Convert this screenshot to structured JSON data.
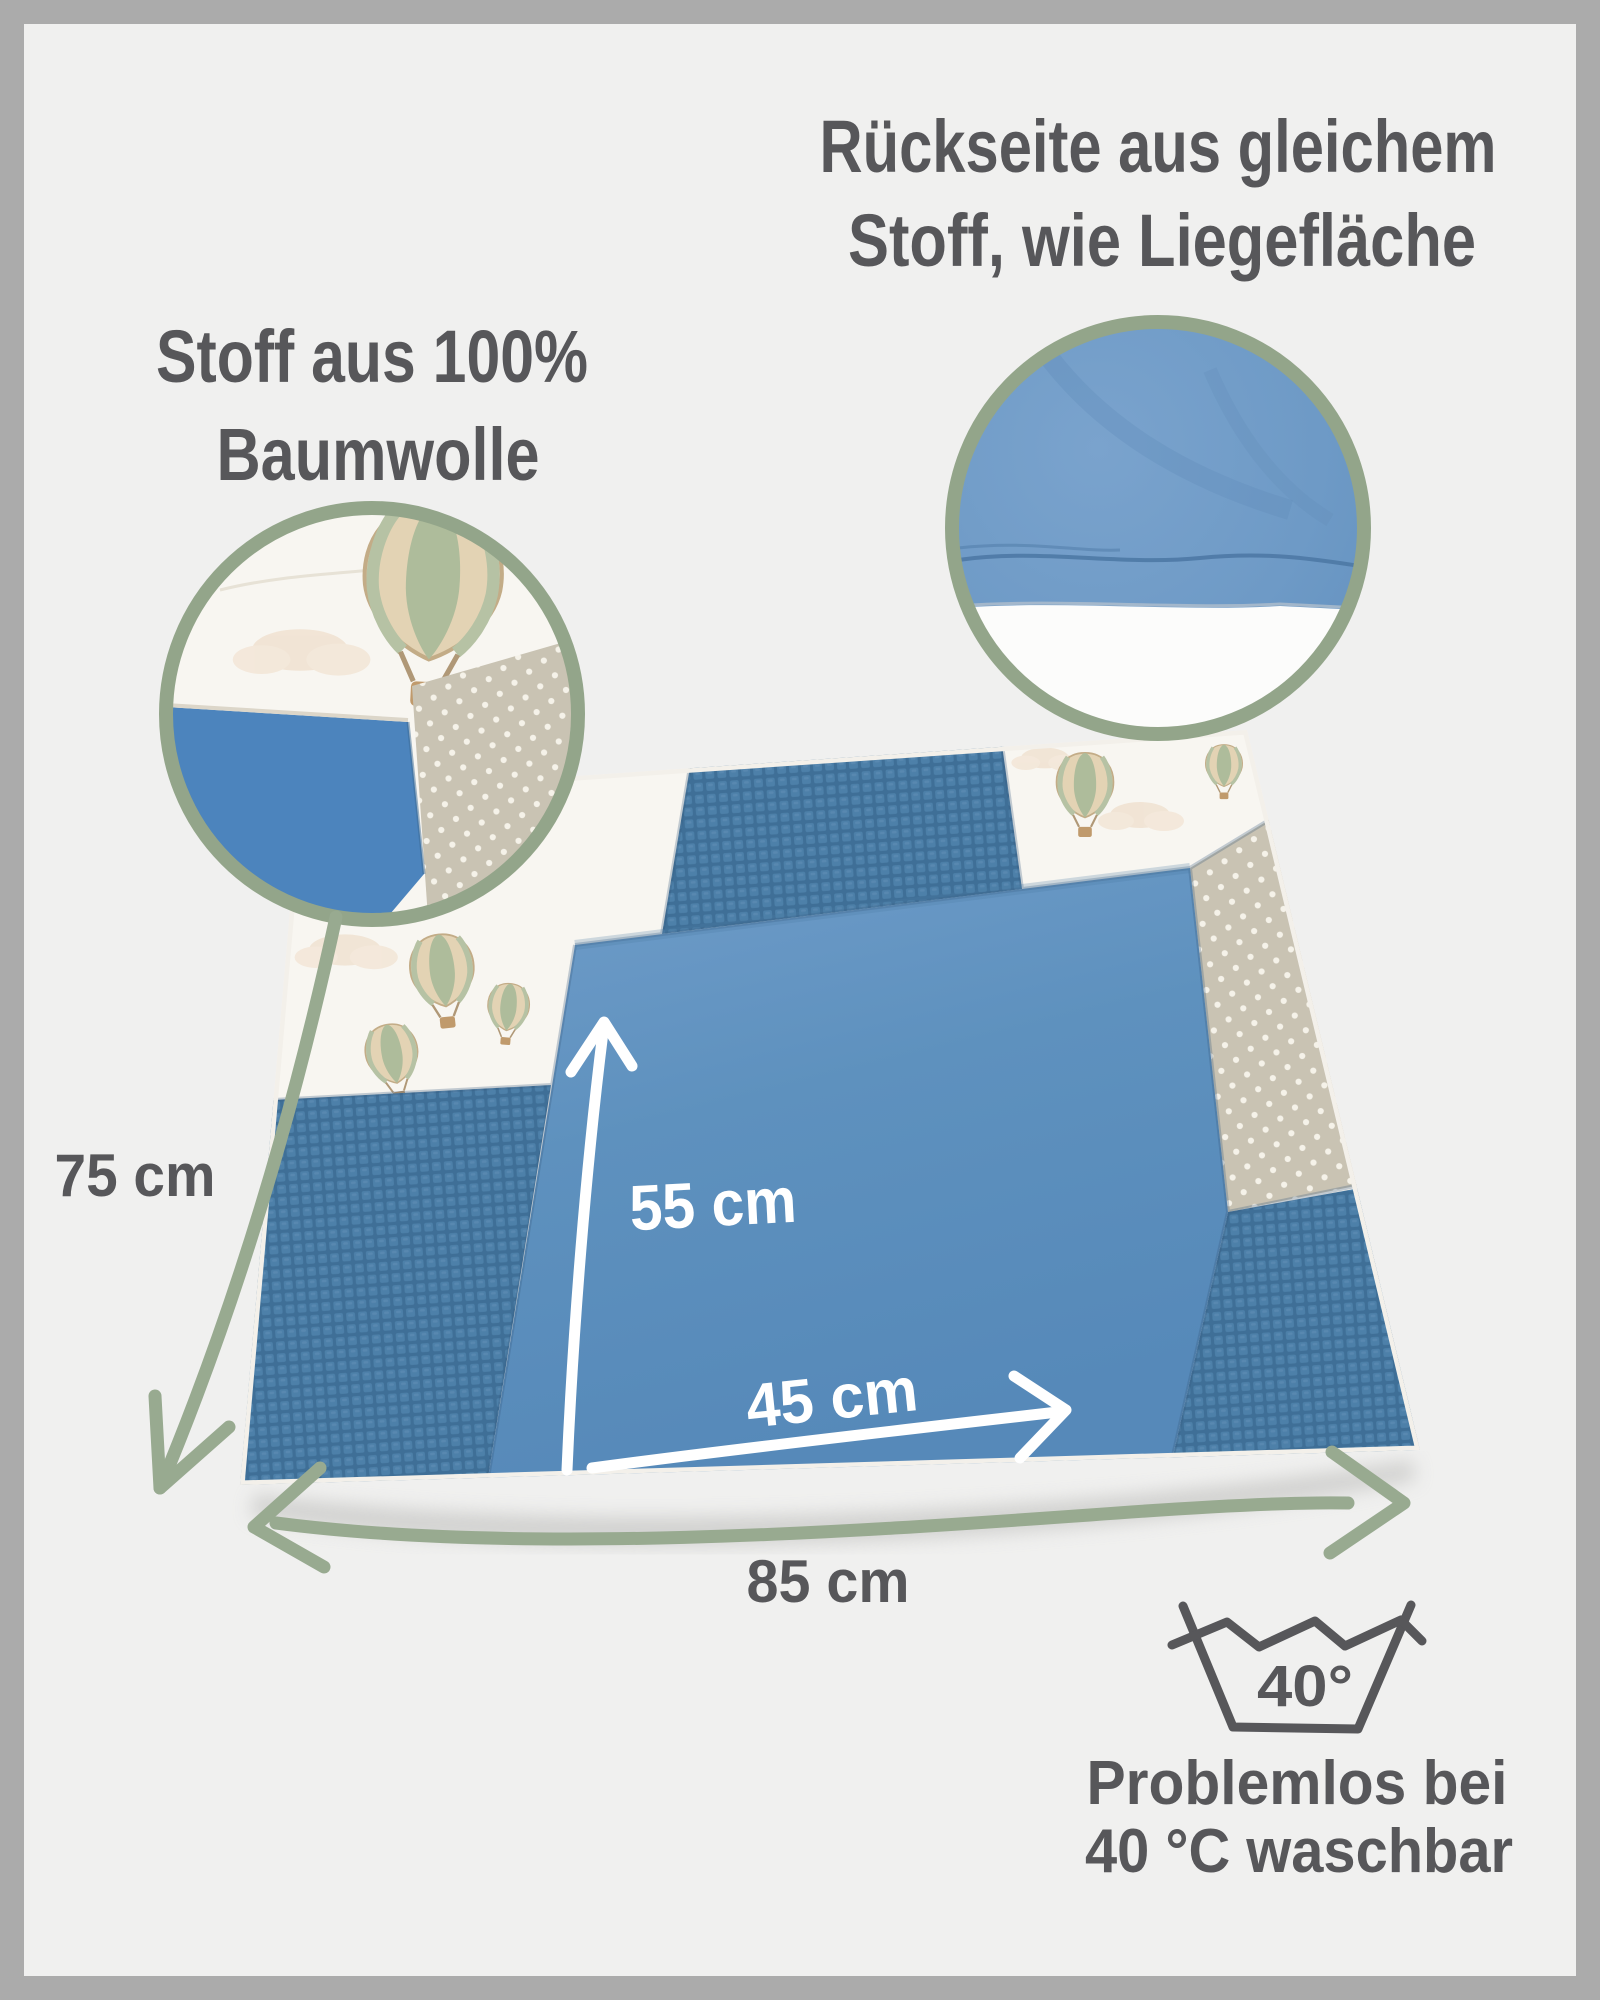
{
  "annotations": {
    "backside": {
      "line1": "Rückseite aus gleichem",
      "line2": "Stoff, wie Liegefläche"
    },
    "fabric": {
      "line1": "Stoff aus 100%",
      "line2": "Baumwolle"
    }
  },
  "measurements": {
    "mat_height": "75 cm",
    "surface_height": "55 cm",
    "surface_width": "45 cm",
    "mat_width": "85 cm"
  },
  "care": {
    "wash_temperature": "40°",
    "note_line1": "Problemlos bei",
    "note_line2": "40 °C waschbar"
  },
  "icons": {
    "wash_tub": "wash-tub-icon",
    "balloon": "hot-air-balloon-icon",
    "cloud": "cloud-icon",
    "detail_inset": "detail-inset-circle"
  },
  "colors": {
    "frame": "#ababab",
    "background": "#f0f0ef",
    "text_dark": "#57575a",
    "sage_green": "#98aa90",
    "ring_green": "#93a58a",
    "mat_surface_blue": "#5d90bd",
    "waffle_blue": "#47799f",
    "dot_fabric_beige": "#c9c3b3",
    "print_fabric_white": "#f8f6f1",
    "backside_blue": "#6e9ac6",
    "arrow_white": "#ffffff"
  }
}
